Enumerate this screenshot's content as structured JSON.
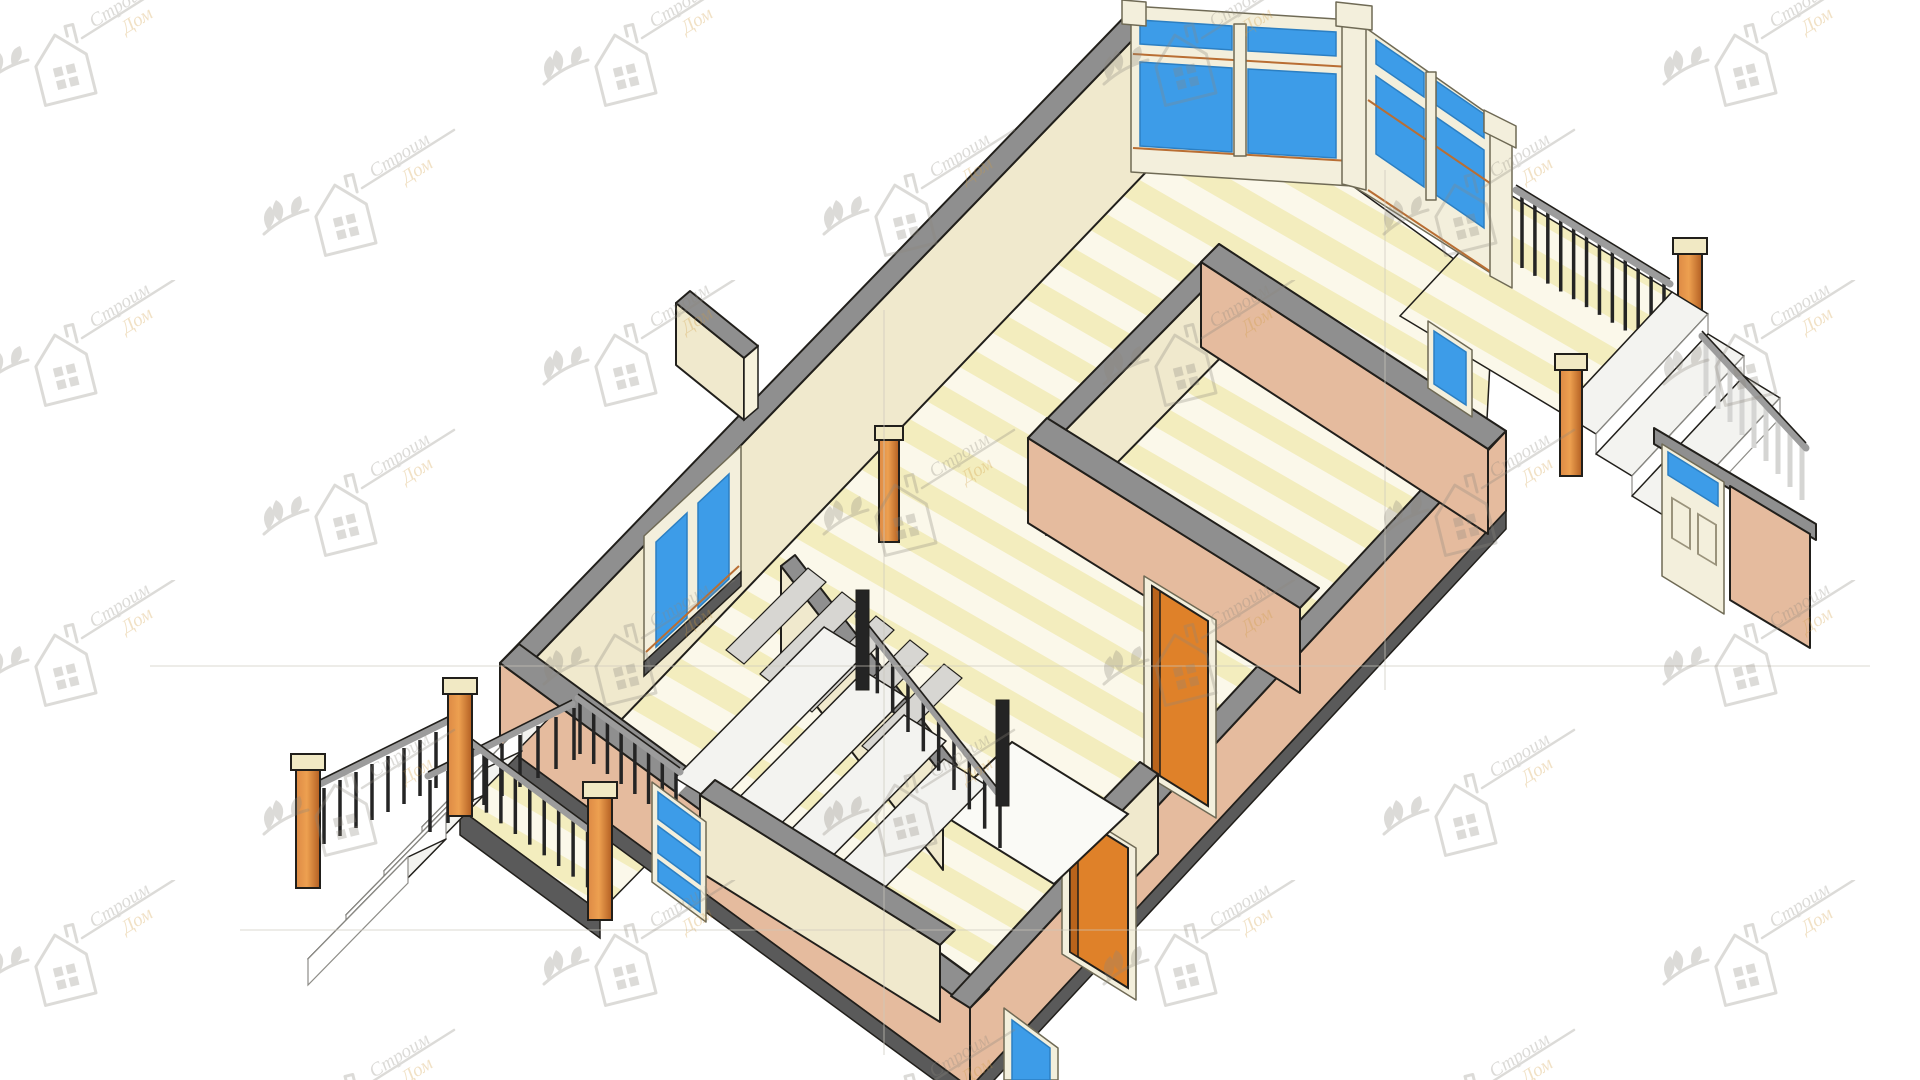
{
  "view": {
    "type": "3d-isometric-cutaway-floor-plan",
    "style": "architectural CAD rendering, first floor, cut walls with gray caps",
    "background": "white with repeating diagonal logo watermark"
  },
  "watermark": {
    "line1": "Строим",
    "line2": "Дом"
  },
  "palette": {
    "bg": "#ffffff",
    "outline": "#211f1b",
    "cap": "#8f8f8f",
    "cap_dark": "#6e6e6e",
    "cream": "#f0e9cd",
    "cream_light": "#f7f2dc",
    "salmon": "#e5bb9e",
    "salmon_dark": "#d9a village#",
    "plinth": "#5a5a5a",
    "floor_light": "#fbf8ea",
    "floor_yellow": "#f3edbe",
    "glass": "#3d9ce8",
    "glass_dark": "#2c7fc2",
    "frame": "#f3efdc",
    "frame_shade": "#cdc7ae",
    "trim_orange": "#b96e33",
    "door_orange": "#df8129",
    "door_orange_dark": "#b9641c",
    "wood": "#dd8a45",
    "wood_dark": "#b35f22",
    "wood_cap": "#f1e9c4",
    "tread": "#f3f3f0",
    "tread_gray": "#d7d6d2",
    "riser": "#ffffff",
    "baluster": "#242424",
    "handrail": "#9c9c9c",
    "rail_white": "#d5d5d3",
    "guide": "#ccc8bd",
    "wm_gray": "#8a867c",
    "wm_orange": "#cf9a3f"
  },
  "scene_inventory": {
    "rooms_visible": 5,
    "window_wall_panels": 4,
    "corner_bay_window": true,
    "left_wall_window_panes": 2,
    "small_rear_window": true,
    "interior_orange_doors": 2,
    "glazed_entry_door_left": true,
    "panel_entry_door_right": true,
    "interior_u_stair_with_landing": true,
    "left_porch_steps": 4,
    "right_deck_steps": 3,
    "wood_posts": 6,
    "freestanding_column": true
  }
}
